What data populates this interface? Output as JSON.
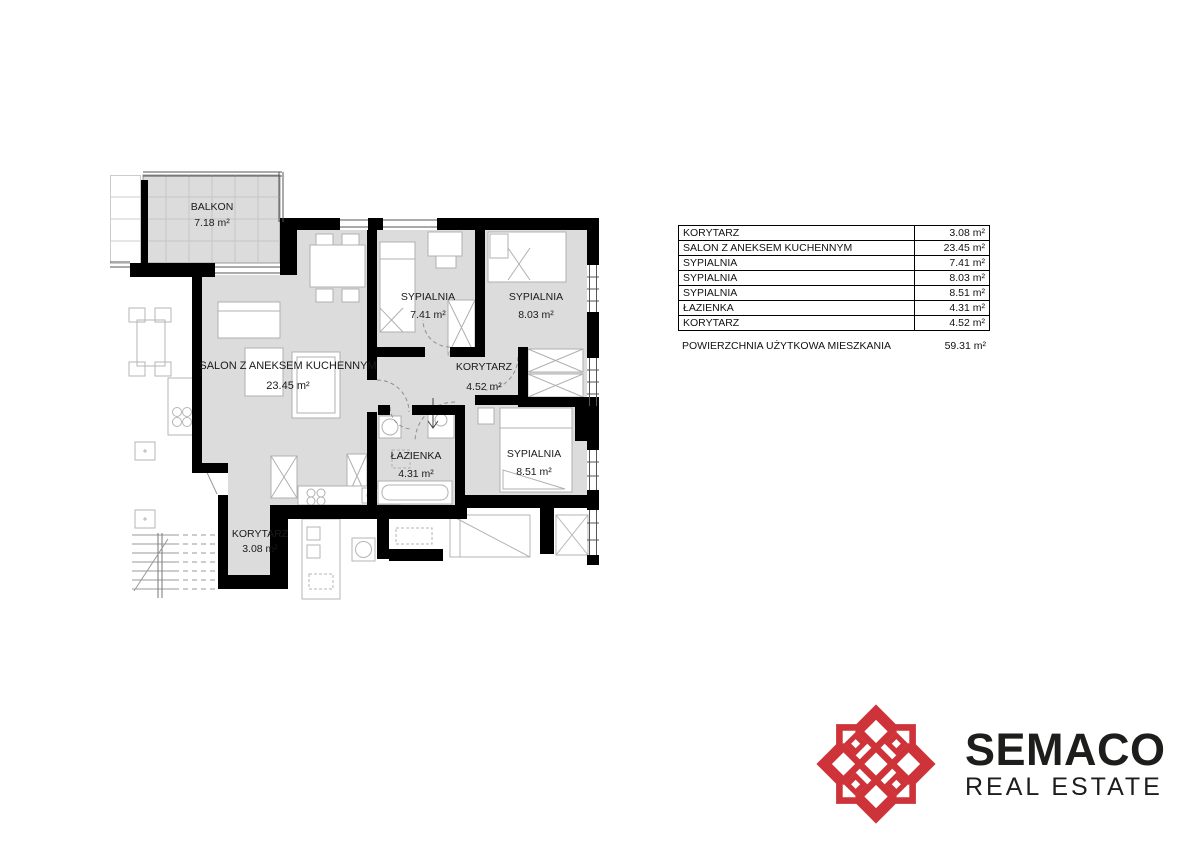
{
  "plan": {
    "balkon": {
      "name": "BALKON",
      "area": "7.18 m²"
    },
    "salon": {
      "name": "SALON Z ANEKSEM KUCHENNYM",
      "area": "23.45 m²"
    },
    "sypialnia1": {
      "name": "SYPIALNIA",
      "area": "7.41 m²"
    },
    "sypialnia2": {
      "name": "SYPIALNIA",
      "area": "8.03 m²"
    },
    "korytarz1": {
      "name": "KORYTARZ",
      "area": "4.52 m²"
    },
    "lazienka": {
      "name": "ŁAZIENKA",
      "area": "4.31 m²"
    },
    "sypialnia3": {
      "name": "SYPIALNIA",
      "area": "8.51 m²"
    },
    "korytarz2": {
      "name": "KORYTARZ",
      "area": "3.08 m²"
    }
  },
  "table": {
    "rows": [
      {
        "name": "KORYTARZ",
        "area": "3.08 m²"
      },
      {
        "name": "SALON Z ANEKSEM KUCHENNYM",
        "area": "23.45 m²"
      },
      {
        "name": "SYPIALNIA",
        "area": "7.41 m²"
      },
      {
        "name": "SYPIALNIA",
        "area": "8.03 m²"
      },
      {
        "name": "SYPIALNIA",
        "area": "8.51 m²"
      },
      {
        "name": "ŁAZIENKA",
        "area": "4.31 m²"
      },
      {
        "name": "KORYTARZ",
        "area": "4.52 m²"
      }
    ],
    "total": {
      "label": "POWIERZCHNIA UŻYTKOWA MIESZKANIA",
      "value": "59.31 m²"
    }
  },
  "logo": {
    "name": "SEMACO",
    "tagline": "REAL ESTATE",
    "brand_color": "#ce3339"
  },
  "colors": {
    "room_fill": "#dcdcdc",
    "wall": "#000000"
  }
}
